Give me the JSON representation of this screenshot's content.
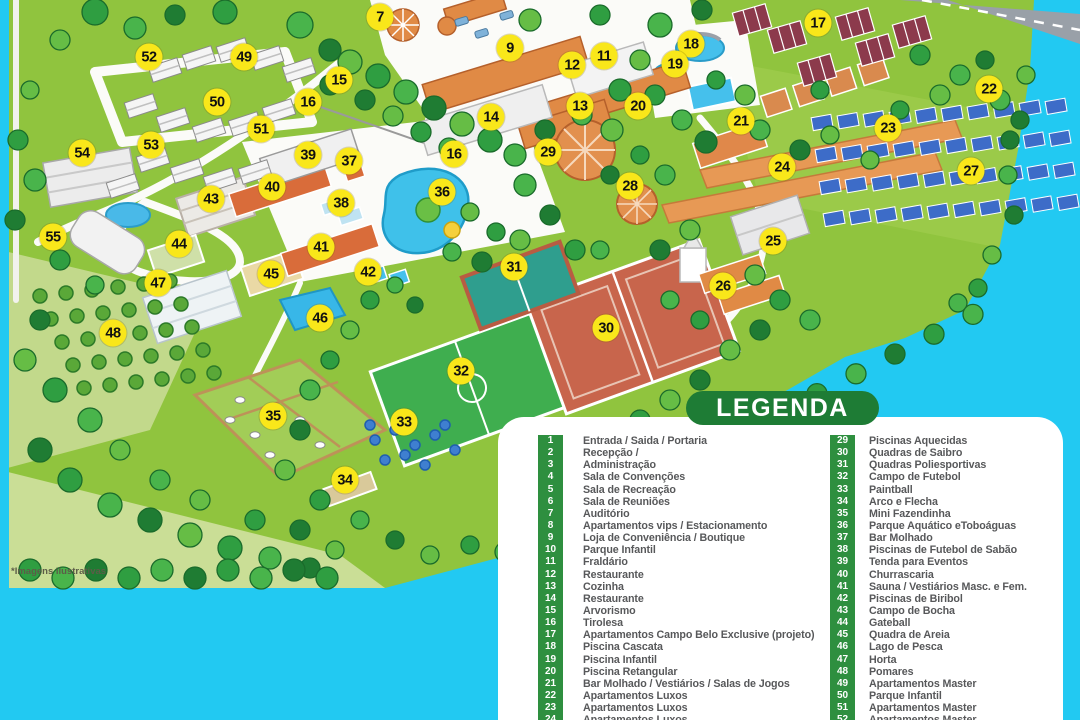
{
  "map": {
    "footnote": "*Imagens ilustrativas",
    "marker_color": "#F9E71A",
    "water_color": "#22C9F2",
    "grass_color": "#90C43E",
    "markers": [
      {
        "label": "7",
        "x": 380,
        "y": 17
      },
      {
        "label": "9",
        "x": 510,
        "y": 48
      },
      {
        "label": "11",
        "x": 604,
        "y": 56
      },
      {
        "label": "12",
        "x": 572,
        "y": 65
      },
      {
        "label": "13",
        "x": 580,
        "y": 106
      },
      {
        "label": "14",
        "x": 491,
        "y": 117
      },
      {
        "label": "15",
        "x": 339,
        "y": 80
      },
      {
        "label": "16",
        "x": 308,
        "y": 102
      },
      {
        "label": "16",
        "x": 454,
        "y": 154
      },
      {
        "label": "17",
        "x": 818,
        "y": 23
      },
      {
        "label": "18",
        "x": 691,
        "y": 44
      },
      {
        "label": "19",
        "x": 675,
        "y": 64
      },
      {
        "label": "20",
        "x": 638,
        "y": 106
      },
      {
        "label": "21",
        "x": 741,
        "y": 121
      },
      {
        "label": "22",
        "x": 989,
        "y": 89
      },
      {
        "label": "23",
        "x": 888,
        "y": 128
      },
      {
        "label": "24",
        "x": 782,
        "y": 167
      },
      {
        "label": "25",
        "x": 773,
        "y": 241
      },
      {
        "label": "26",
        "x": 723,
        "y": 286
      },
      {
        "label": "27",
        "x": 971,
        "y": 171
      },
      {
        "label": "28",
        "x": 630,
        "y": 186
      },
      {
        "label": "29",
        "x": 548,
        "y": 152
      },
      {
        "label": "30",
        "x": 606,
        "y": 328
      },
      {
        "label": "31",
        "x": 514,
        "y": 267
      },
      {
        "label": "32",
        "x": 461,
        "y": 371
      },
      {
        "label": "33",
        "x": 404,
        "y": 422
      },
      {
        "label": "34",
        "x": 345,
        "y": 480
      },
      {
        "label": "35",
        "x": 273,
        "y": 416
      },
      {
        "label": "36",
        "x": 442,
        "y": 192
      },
      {
        "label": "37",
        "x": 349,
        "y": 161
      },
      {
        "label": "38",
        "x": 341,
        "y": 203
      },
      {
        "label": "39",
        "x": 308,
        "y": 155
      },
      {
        "label": "40",
        "x": 272,
        "y": 187
      },
      {
        "label": "41",
        "x": 321,
        "y": 247
      },
      {
        "label": "42",
        "x": 368,
        "y": 272
      },
      {
        "label": "43",
        "x": 211,
        "y": 199
      },
      {
        "label": "44",
        "x": 179,
        "y": 244
      },
      {
        "label": "45",
        "x": 271,
        "y": 274
      },
      {
        "label": "46",
        "x": 320,
        "y": 318
      },
      {
        "label": "47",
        "x": 158,
        "y": 283
      },
      {
        "label": "48",
        "x": 113,
        "y": 333
      },
      {
        "label": "49",
        "x": 244,
        "y": 57
      },
      {
        "label": "50",
        "x": 217,
        "y": 102
      },
      {
        "label": "51",
        "x": 261,
        "y": 129
      },
      {
        "label": "52",
        "x": 149,
        "y": 57
      },
      {
        "label": "53",
        "x": 151,
        "y": 145
      },
      {
        "label": "54",
        "x": 82,
        "y": 153
      },
      {
        "label": "55",
        "x": 53,
        "y": 237
      }
    ]
  },
  "legend": {
    "title": "LEGENDA",
    "header_bg": "#1E7C35",
    "chip_bg": "#2E8F3F",
    "columns": [
      {
        "items": [
          {
            "num": "1",
            "label": "Entrada / Saida / Portaria"
          },
          {
            "num": "2",
            "label": "Recepção /"
          },
          {
            "num": "3",
            "label": "Administração"
          },
          {
            "num": "4",
            "label": "Sala de Convenções"
          },
          {
            "num": "5",
            "label": "Sala de Recreação"
          },
          {
            "num": "6",
            "label": "Sala de Reuniões"
          },
          {
            "num": "7",
            "label": "Auditório"
          },
          {
            "num": "8",
            "label": "Apartamentos vips / Estacionamento"
          },
          {
            "num": "9",
            "label": "Loja de Conveniência / Boutique"
          },
          {
            "num": "10",
            "label": "Parque Infantil"
          },
          {
            "num": "11",
            "label": "Fraldário"
          },
          {
            "num": "12",
            "label": "Restaurante"
          },
          {
            "num": "13",
            "label": "Cozinha"
          },
          {
            "num": "14",
            "label": "Restaurante"
          },
          {
            "num": "15",
            "label": "Arvorismo"
          },
          {
            "num": "16",
            "label": "Tirolesa"
          },
          {
            "num": "17",
            "label": "Apartamentos Campo Belo Exclusive (projeto)"
          },
          {
            "num": "18",
            "label": "Piscina Cascata"
          },
          {
            "num": "19",
            "label": "Piscina Infantil"
          },
          {
            "num": "20",
            "label": "Piscina Retangular"
          },
          {
            "num": "21",
            "label": "Bar Molhado / Vestiários / Salas de Jogos"
          },
          {
            "num": "22",
            "label": "Apartamentos Luxos"
          },
          {
            "num": "23",
            "label": "Apartamentos Luxos"
          },
          {
            "num": "24",
            "label": "Apartamentos Luxos"
          }
        ]
      },
      {
        "items": [
          {
            "num": "29",
            "label": "Piscinas Aquecidas"
          },
          {
            "num": "30",
            "label": "Quadras de Saibro"
          },
          {
            "num": "31",
            "label": "Quadras Poliesportivas"
          },
          {
            "num": "32",
            "label": "Campo de Futebol"
          },
          {
            "num": "33",
            "label": "Paintball"
          },
          {
            "num": "34",
            "label": "Arco e Flecha"
          },
          {
            "num": "35",
            "label": "Mini Fazendinha"
          },
          {
            "num": "36",
            "label": "Parque Aquático eToboáguas"
          },
          {
            "num": "37",
            "label": "Bar Molhado"
          },
          {
            "num": "38",
            "label": "Piscinas de Futebol de Sabão"
          },
          {
            "num": "39",
            "label": "Tenda para Eventos"
          },
          {
            "num": "40",
            "label": "Churrascaria"
          },
          {
            "num": "41",
            "label": "Sauna / Vestiários Masc. e Fem."
          },
          {
            "num": "42",
            "label": "Piscinas de Biribol"
          },
          {
            "num": "43",
            "label": "Campo de Bocha"
          },
          {
            "num": "44",
            "label": "Gateball"
          },
          {
            "num": "45",
            "label": "Quadra de Areia"
          },
          {
            "num": "46",
            "label": "Lago de Pesca"
          },
          {
            "num": "47",
            "label": "Horta"
          },
          {
            "num": "48",
            "label": "Pomares"
          },
          {
            "num": "49",
            "label": "Apartamentos Master"
          },
          {
            "num": "50",
            "label": "Parque Infantil"
          },
          {
            "num": "51",
            "label": "Apartamentos Master"
          },
          {
            "num": "52",
            "label": "Apartamentos Master"
          }
        ]
      }
    ]
  }
}
